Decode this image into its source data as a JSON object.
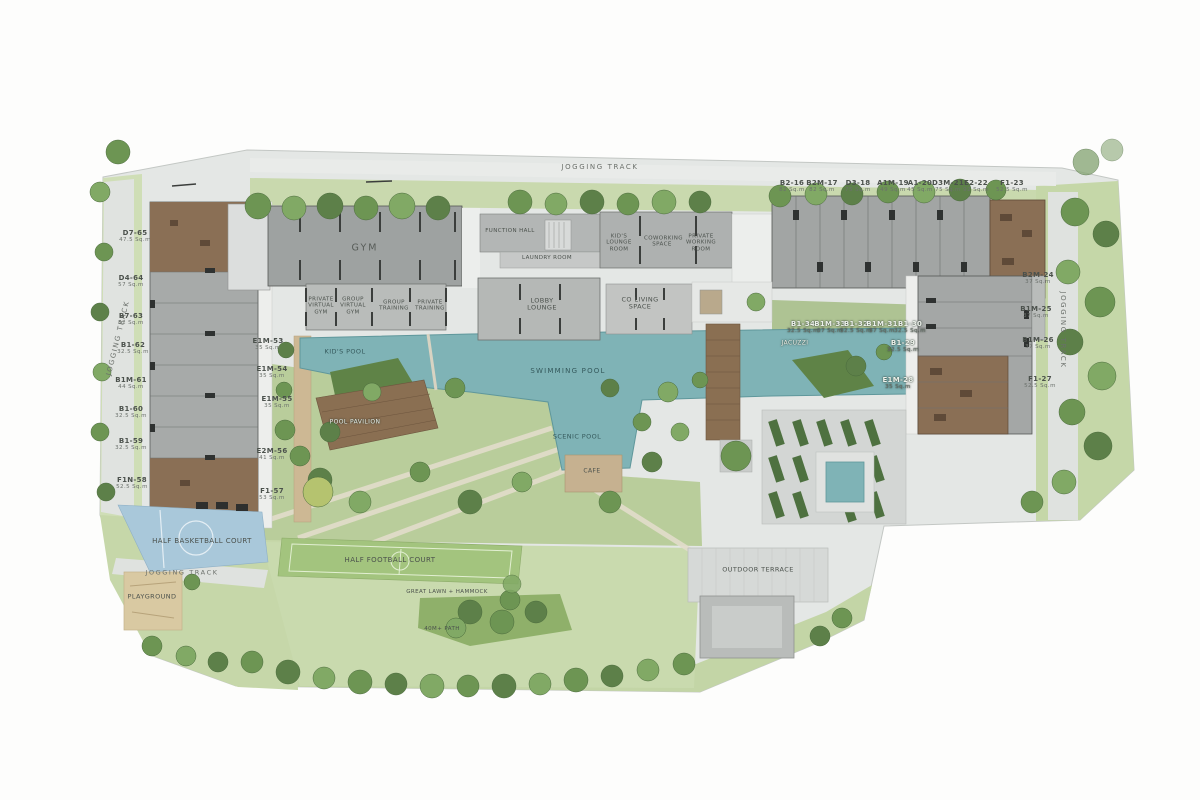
{
  "plan_title": "Condominium Master Plan",
  "track": {
    "top": "JOGGING TRACK",
    "left": "JOGGING TRACK",
    "right": "JOGGING TRACK",
    "bottom": "JOGGING TRACK"
  },
  "facilities": {
    "gym": "GYM",
    "private_virtual_gym": "PRIVATE VIRTUAL GYM",
    "group_virtual_gym": "GROUP VIRTUAL GYM",
    "group_training": "GROUP TRAINING",
    "private_training": "PRIVATE TRAINING",
    "function_hall": "FUNCTION HALL",
    "laundry_room": "LAUNDRY ROOM",
    "kids_lounge_room": "KID'S LOUNGE ROOM",
    "coworking_space": "COWORKING SPACE",
    "private_working_room": "PRIVATE WORKING ROOM",
    "lobby_lounge": "LOBBY LOUNGE",
    "co_living_space": "CO LIVING SPACE",
    "kids_pool": "KID'S POOL",
    "swimming_pool": "SWIMMING POOL",
    "scenic_pool": "SCENIC POOL",
    "jacuzzi": "JACUZZI",
    "cafe": "CAFE",
    "pool_pavilion": "POOL PAVILION",
    "half_basketball_court": "HALF BASKETBALL COURT",
    "playground": "PLAYGROUND",
    "half_football_court": "HALF FOOTBALL COURT",
    "lawn_hammock": "GREAT LAWN + HAMMOCK",
    "path_40m": "40M+ PATH",
    "outdoor_terrace": "OUTDOOR TERRACE"
  },
  "units": {
    "top": [
      {
        "code": "B2-16",
        "area": "82 Sq.m"
      },
      {
        "code": "B2M-17",
        "area": "82 Sq.m"
      },
      {
        "code": "D3-18",
        "area": "75 Sq.m"
      },
      {
        "code": "A1M-19",
        "area": "49 Sq.m"
      },
      {
        "code": "A1-20",
        "area": "45 Sq.m"
      },
      {
        "code": "D3M-21",
        "area": "75 Sq.m"
      },
      {
        "code": "E2-22",
        "area": "92 Sq.m"
      },
      {
        "code": "F1-23",
        "area": "52.5 Sq.m"
      }
    ],
    "left": [
      {
        "code": "D7-65",
        "area": "47.5 Sq.m"
      },
      {
        "code": "D4-64",
        "area": "57 Sq.m"
      },
      {
        "code": "B7-63",
        "area": "52 Sq.m"
      },
      {
        "code": "B1-62",
        "area": "32.5 Sq.m"
      },
      {
        "code": "B1M-61",
        "area": "44 Sq.m"
      },
      {
        "code": "B1-60",
        "area": "32.5 Sq.m"
      },
      {
        "code": "B1-59",
        "area": "32.5 Sq.m"
      },
      {
        "code": "F1N-58",
        "area": "52.5 Sq.m"
      }
    ],
    "right": [
      {
        "code": "B2M-24",
        "area": "37 Sq.m"
      },
      {
        "code": "B1M-25",
        "area": "37 Sq.m"
      },
      {
        "code": "B1M-26",
        "area": "37 Sq.m"
      },
      {
        "code": "F1-27",
        "area": "52.5 Sq.m"
      }
    ],
    "mid": [
      {
        "code": "B1-34",
        "area": "32.5 Sq.m"
      },
      {
        "code": "B1M-33",
        "area": "37 Sq.m"
      },
      {
        "code": "B1-32",
        "area": "32.5 Sq.m"
      },
      {
        "code": "B1M-31",
        "area": "37 Sq.m"
      },
      {
        "code": "B1-30",
        "area": "32.5 Sq.m"
      },
      {
        "code": "B1-29",
        "area": "32.5 Sq.m"
      },
      {
        "code": "E1M-28",
        "area": "35 Sq.m"
      }
    ],
    "poolside": [
      {
        "code": "E1M-53",
        "area": "35 Sq.m"
      },
      {
        "code": "E1M-54",
        "area": "35 Sq.m"
      },
      {
        "code": "E1M-55",
        "area": "35 Sq.m"
      },
      {
        "code": "E2M-56",
        "area": "41 Sq.m"
      },
      {
        "code": "F1-57",
        "area": "53 Sq.m"
      }
    ]
  }
}
